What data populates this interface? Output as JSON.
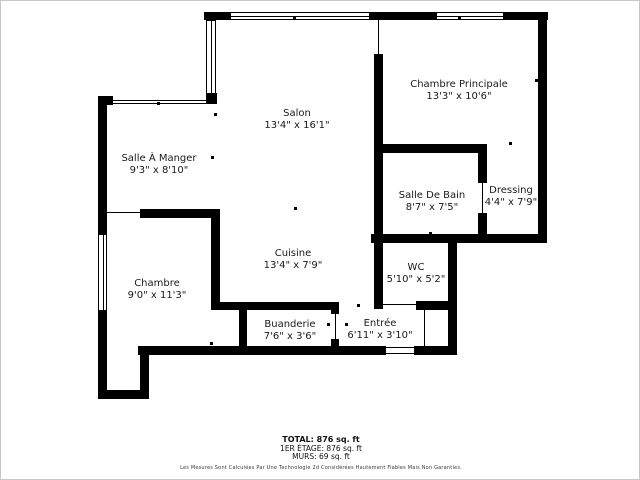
{
  "meta": {
    "background_color": "#ffffff",
    "wall_color": "#000000",
    "frame_border_color": "#c8c8c8",
    "label_color": "#1a1a1a"
  },
  "rooms": [
    {
      "key": "salon",
      "name": "Salon",
      "dims": "13'4\" x 16'1\"",
      "cx": 296,
      "cy": 119
    },
    {
      "key": "salle-a-manger",
      "name": "Salle À Manger",
      "dims": "9'3\" x 8'10\"",
      "cx": 158,
      "cy": 164
    },
    {
      "key": "chambre-principale",
      "name": "Chambre Principale",
      "dims": "13'3\" x 10'6\"",
      "cx": 458,
      "cy": 90
    },
    {
      "key": "salle-de-bain",
      "name": "Salle De Bain",
      "dims": "8'7\" x 7'5\"",
      "cx": 431,
      "cy": 201
    },
    {
      "key": "dressing",
      "name": "Dressing",
      "dims": "4'4\" x 7'9\"",
      "cx": 510,
      "cy": 196
    },
    {
      "key": "wc",
      "name": "WC",
      "dims": "5'10\" x 5'2\"",
      "cx": 415,
      "cy": 273
    },
    {
      "key": "cuisine",
      "name": "Cuisine",
      "dims": "13'4\" x 7'9\"",
      "cx": 292,
      "cy": 259
    },
    {
      "key": "chambre",
      "name": "Chambre",
      "dims": "9'0\" x 11'3\"",
      "cx": 156,
      "cy": 289
    },
    {
      "key": "buanderie",
      "name": "Buanderie",
      "dims": "7'6\" x 3'6\"",
      "cx": 289,
      "cy": 330
    },
    {
      "key": "entree",
      "name": "Entrée",
      "dims": "6'11\" x 3'10\"",
      "cx": 379,
      "cy": 329
    }
  ],
  "summary": {
    "total": "TOTAL: 876 sq. ft",
    "floor": "1ER ÉTAGE: 876 sq. ft",
    "walls": "MURS: 69 sq. ft",
    "disclaimer": "Les Mesures Sont Calculées Par Une Technologie 2d Considérées Hautement Fiables Mais Non Garanties."
  },
  "geometry": {
    "walls": [
      [
        203,
        11,
        344,
        8
      ],
      [
        97,
        95,
        9,
        303
      ],
      [
        97,
        95,
        15,
        9
      ],
      [
        205,
        92,
        11,
        11
      ],
      [
        537,
        11,
        9,
        231
      ],
      [
        370,
        233,
        176,
        9
      ],
      [
        447,
        233,
        9,
        121
      ],
      [
        415,
        300,
        33,
        9
      ],
      [
        137,
        345,
        319,
        9
      ],
      [
        139,
        345,
        9,
        53
      ],
      [
        97,
        389,
        51,
        9
      ],
      [
        373,
        53,
        9,
        255
      ],
      [
        373,
        143,
        112,
        9
      ],
      [
        477,
        143,
        9,
        39
      ],
      [
        477,
        212,
        9,
        30
      ],
      [
        139,
        208,
        80,
        9
      ],
      [
        210,
        208,
        9,
        101
      ],
      [
        210,
        301,
        127,
        8
      ],
      [
        238,
        301,
        8,
        53
      ],
      [
        330,
        301,
        8,
        12
      ],
      [
        330,
        338,
        8,
        16
      ]
    ],
    "gaps": [
      [
        385,
        345,
        28,
        9
      ]
    ],
    "windows": [
      {
        "rect": [
          229,
          11,
          140,
          8
        ],
        "o": "h"
      },
      {
        "rect": [
          435,
          11,
          68,
          8
        ],
        "o": "h"
      },
      {
        "rect": [
          205,
          19,
          10,
          74
        ],
        "o": "v"
      },
      {
        "rect": [
          97,
          233,
          9,
          77
        ],
        "o": "v"
      }
    ],
    "door_lines": [
      [
        377,
        19,
        1,
        34
      ],
      [
        106,
        99,
        100,
        1
      ],
      [
        106,
        102,
        100,
        1
      ],
      [
        106,
        211,
        34,
        1
      ],
      [
        382,
        303,
        33,
        1
      ],
      [
        413,
        237,
        32,
        1
      ],
      [
        481,
        182,
        1,
        30
      ],
      [
        334,
        313,
        1,
        25
      ],
      [
        423,
        309,
        1,
        36
      ],
      [
        385,
        346,
        28,
        1
      ],
      [
        385,
        352,
        28,
        1
      ]
    ],
    "ticks": [
      [
        292,
        16
      ],
      [
        457,
        16
      ],
      [
        534,
        78
      ],
      [
        376,
        78
      ],
      [
        97,
        155
      ],
      [
        210,
        155
      ],
      [
        156,
        101
      ],
      [
        156,
        210
      ],
      [
        293,
        206
      ],
      [
        209,
        341
      ],
      [
        356,
        303
      ],
      [
        326,
        322
      ],
      [
        344,
        322
      ],
      [
        379,
        349
      ],
      [
        414,
        349
      ],
      [
        416,
        300
      ],
      [
        428,
        231
      ],
      [
        477,
        179
      ],
      [
        477,
        213
      ],
      [
        508,
        141
      ],
      [
        213,
        112
      ],
      [
        97,
        346
      ]
    ]
  }
}
